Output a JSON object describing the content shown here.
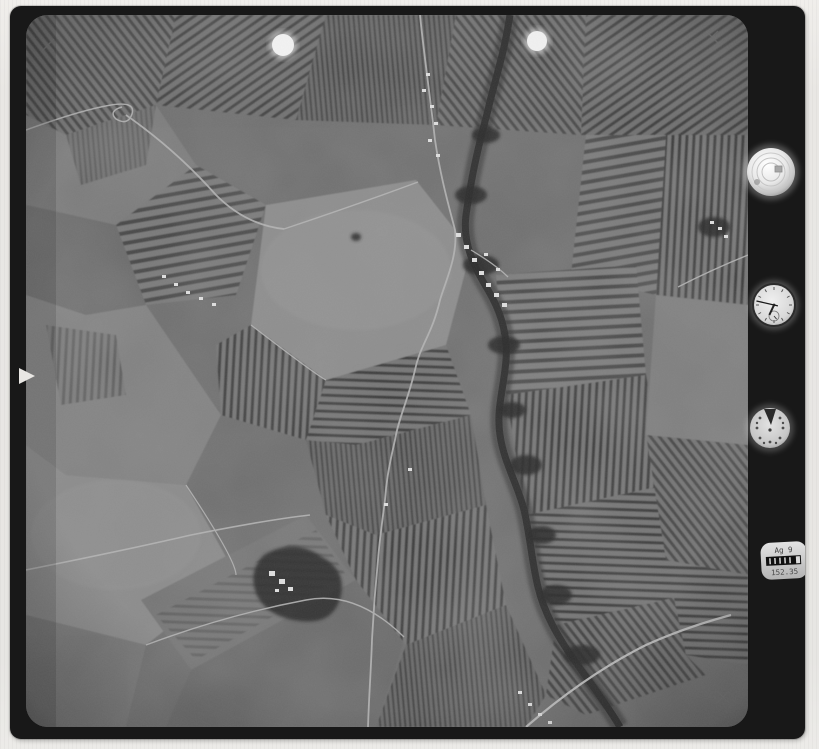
{
  "scene": {
    "kind": "vintage monochrome vertical aerial survey photograph",
    "content": "patchwork farmland with striped vineyard fields, a dark meandering tree-lined stream, light country roads, small villages and a wooded farm estate",
    "film_frame": "black negative carrier frame with rounded corners on light scanner paper background"
  },
  "palette": {
    "paper": "#eae8e5",
    "frame_black": "#181818",
    "photo_base": "#6f6f6f",
    "photo_light_field": "#8f8f8f",
    "photo_dark_stripe": "#3e3e3e",
    "stream_dark": "#343434",
    "road_light": "#b4b4b4",
    "marker_white": "#f3f3f3"
  },
  "frame_marks": {
    "fiducial_glyph": "×",
    "fiducial_positions": [
      "top-left",
      "top-right",
      "bottom-left",
      "bottom-right"
    ],
    "registration_lamp_count": "2",
    "film_notch": "white triangular notch on left edge"
  },
  "instrument_panel": {
    "bubble_level": {
      "label": "spherical bubble level"
    },
    "clock": {
      "time_reading": "9:47",
      "hour_hand_transform": "rotate(205 764 299)",
      "minute_hand_transform": "rotate(283 764 299)",
      "subdial_needle_transform": "rotate(140 764 310)"
    },
    "altimeter": {
      "pointer": "dark wedge at 12 o'clock"
    },
    "data_strip": {
      "line1": "Ag 9",
      "line2": "152.35"
    }
  }
}
